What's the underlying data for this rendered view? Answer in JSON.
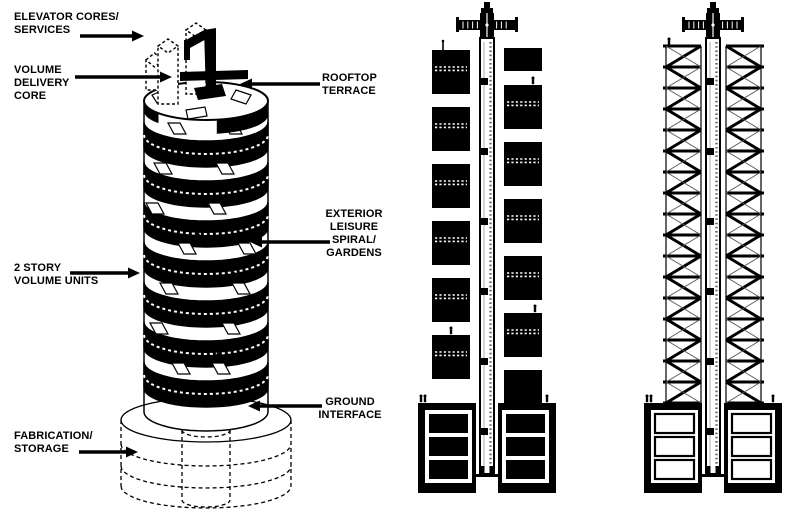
{
  "colors": {
    "background": "#ffffff",
    "ink": "#000000"
  },
  "labels": {
    "elevator_cores": "ELEVATOR CORES/\nSERVICES",
    "volume_delivery_core": "VOLUME\nDELIVERY\nCORE",
    "rooftop_terrace": "ROOFTOP\nTERRACE",
    "exterior_leisure": "EXTERIOR\nLEISURE\nSPIRAL/\nGARDENS",
    "two_story_volume_units": "2 STORY\nVOLUME UNITS",
    "ground_interface": "GROUND\nINTERFACE",
    "fabrication_storage": "FABRICATION/\nSTORAGE"
  },
  "figures": {
    "axonometric_tower": {
      "volume_band_count": 7
    },
    "section_with_volumes": {
      "left_unit_count": 6,
      "right_unit_count": 7,
      "basement_rows_per_side": 3
    },
    "section_frame_only": {
      "floor_count": 17,
      "basement_rows_per_side": 3
    }
  }
}
